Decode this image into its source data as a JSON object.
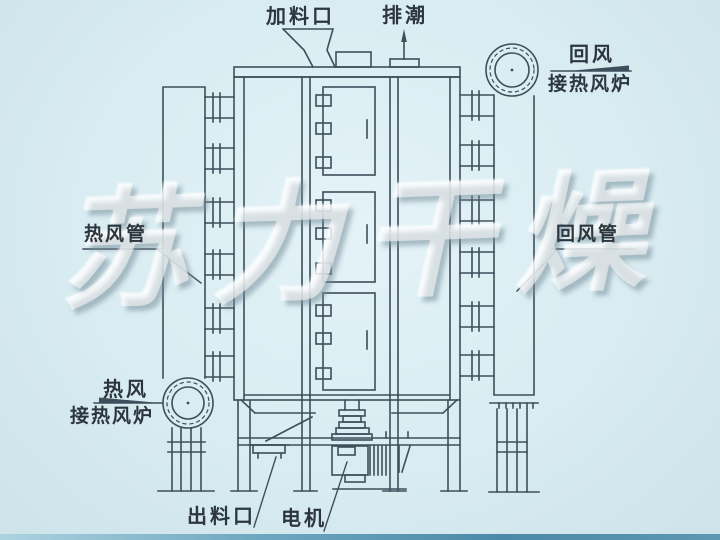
{
  "labels": {
    "feed_port": "加料口",
    "moisture_exhaust": "排潮",
    "return_air": "回风",
    "return_connect": "接热风炉",
    "hot_air_pipe": "热风管",
    "return_air_pipe": "回风管",
    "hot_air": "热风",
    "hot_connect": "接热风炉",
    "discharge_port": "出料口",
    "motor": "电机"
  },
  "watermark": "苏力干燥",
  "colors": {
    "background": "#d8ecf1",
    "line": "#3e4e5a",
    "text": "#2d363e",
    "watermark": "#ffffff",
    "bottom_edge": "#32789c"
  }
}
